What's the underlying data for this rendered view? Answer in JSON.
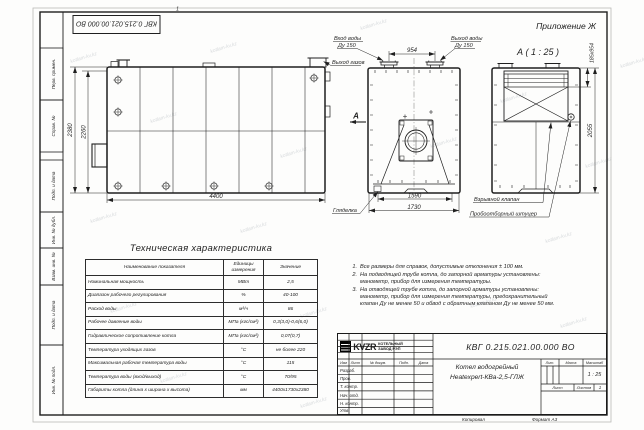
{
  "page": {
    "stamp": "КВГ 0.215.021.00.000 ВО",
    "appendix": "Приложение Ж",
    "zone_mark": "1",
    "watermark": "kotlam-kv.kz",
    "copied": "Копировал",
    "format": "Формат А3"
  },
  "margin_labels": [
    "Перв. примен.",
    "Справ. №",
    "Подп. и дата",
    "Инв. № дубл.",
    "Взам. инв. №",
    "Подп. и дата",
    "Инв. № подл."
  ],
  "drawing": {
    "section_title": "А ( 1 : 25 )",
    "section_letter": "А",
    "dim_2380": "2380",
    "dim_2260": "2260",
    "dim_4400": "4400",
    "dim_954": "954",
    "dim_1590": "1590",
    "dim_1730": "1730",
    "dim_2055": "2055",
    "dim_hatch": "185х954",
    "water_inlet": "Вход воды",
    "water_inlet_dn": "Ду 150",
    "water_outlet": "Выход воды",
    "water_outlet_dn": "Ду 150",
    "gas_outlet": "Выход газов",
    "sight_glass": "Гляделка",
    "explosion_valve": "Взрывной клапан",
    "sampling_nozzle": "Пробоотборный штуцер"
  },
  "tech_table": {
    "title": "Техническая характеристика",
    "headers": [
      "Наименование показателя",
      "Единицы измерения",
      "Значение"
    ],
    "rows": [
      [
        "Номинальная мощность",
        "МВт",
        "2,5"
      ],
      [
        "Диапазон рабочего регулирования",
        "%",
        "40-100"
      ],
      [
        "Расход воды",
        "м³/ч",
        "86"
      ],
      [
        "Рабочее давление воды",
        "МПа (кгс/см²)",
        "0,3(3,0)-0,6(6,0)"
      ],
      [
        "Гидравлическое сопротивление котла",
        "МПа (кгс/см²)",
        "0,07(0,7)"
      ],
      [
        "Температура уходящих газов",
        "°С",
        "не более 220"
      ],
      [
        "Максимальная рабочая температура воды",
        "°С",
        "115"
      ],
      [
        "Температура воды (вход/выход)",
        "°С",
        "70/95"
      ],
      [
        "Габариты котла (длина х ширина х высота)",
        "мм",
        "4400х1730х2380"
      ]
    ]
  },
  "notes": [
    {
      "num": "1.",
      "text": "Все размеры для справок, допустимые отклонения ± 100 мм."
    },
    {
      "num": "2.",
      "text": "На подводящей трубе котла, до запорной арматуры установлены: манометр, прибор для измерения температуры."
    },
    {
      "num": "3.",
      "text": "На отводящей трубе котла, до запорной арматуры установлены: манометр, прибор для измерения температуры, предохранительный клапан Ду не менее 50 и обвод с обратным клапаном Ду не менее 50 мм."
    }
  ],
  "title_block": {
    "designation": "КВГ 0.215.021.00.000 ВО",
    "name_1": "Котел водогрейный",
    "name_2": "Heatexpert-КВа-2,5-ГЛЖ",
    "cols": [
      "Изм",
      "Лист",
      "№ докум.",
      "Подп.",
      "Дата"
    ],
    "rows": [
      "Разраб.",
      "Пров.",
      "Т. контр.",
      "Нач. отд.",
      "Н. контр.",
      "Утв."
    ],
    "lit_label": "Лит.",
    "mass_label": "Масса",
    "scale_label": "Масштаб",
    "scale_value": "1 : 25",
    "sheet_label": "Лист",
    "sheets_label": "Листов",
    "sheets_value": "1",
    "logo_text": "KVZR",
    "company_1": "КОТЕЛЬНЫЙ",
    "company_2": "ЗАВОД РЭП"
  }
}
